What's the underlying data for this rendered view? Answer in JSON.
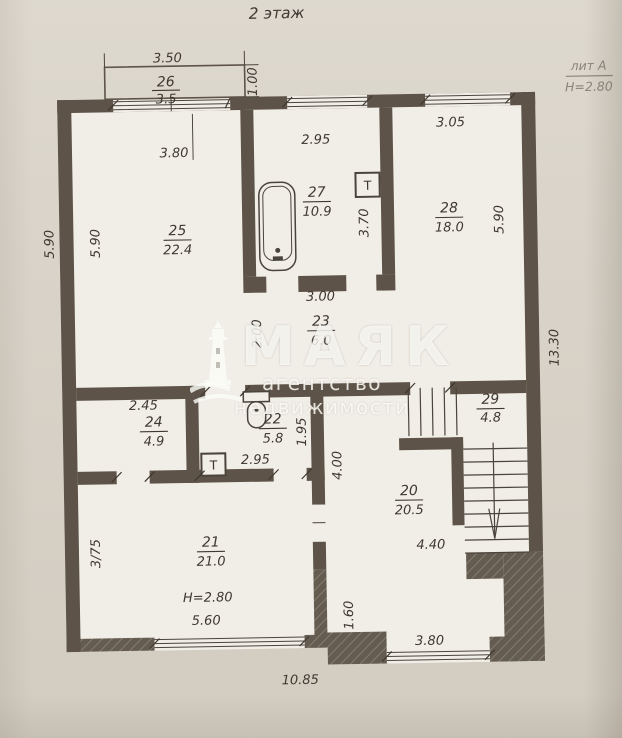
{
  "page": {
    "title": "2 этаж"
  },
  "corner_note": {
    "line1": "лит А",
    "line2": "Н=2.80"
  },
  "watermark": {
    "brand": "МАЯК",
    "subtitle": "агентство недвижимости"
  },
  "rooms": {
    "r20": {
      "number": "20",
      "area": "20.5"
    },
    "r21": {
      "number": "21",
      "area": "21.0"
    },
    "r22": {
      "number": "22",
      "area": "5.8"
    },
    "r23": {
      "number": "23",
      "area": "6.0"
    },
    "r24": {
      "number": "24",
      "area": "4.9"
    },
    "r25": {
      "number": "25",
      "area": "22.4"
    },
    "r26": {
      "number": "26",
      "area": "3.5"
    },
    "r27": {
      "number": "27",
      "area": "10.9"
    },
    "r28": {
      "number": "28",
      "area": "18.0"
    },
    "r29": {
      "number": "29",
      "area": "4.8"
    }
  },
  "dims": {
    "balcony_width": "3.50",
    "balcony_depth": "1.00",
    "room25_width": "3.80",
    "room27_width": "2.95",
    "room28_width": "3.05",
    "outer_left_height": "5.90",
    "room25_height": "5.90",
    "room27_height": "3.70",
    "room28_height": "5.90",
    "outer_right_height": "13.30",
    "room23_width": "3.00",
    "room23_height": "2.00",
    "room24_width": "2.45",
    "room22_width": "2.95",
    "room22_height": "1.95",
    "room20_left_height": "4.00",
    "room20_width": "4.40",
    "room21_left_height": "3/75",
    "room21_ceiling_height": "Н=2.80",
    "room21_window_width": "5.60",
    "room20_step_height": "1.60",
    "room20_window_width": "3.80",
    "building_width": "10.85"
  },
  "symbols": {
    "boiler_bathroom": "Т",
    "boiler_wc": "Т"
  },
  "colors": {
    "paper": "#d9d3c9",
    "plan_paper": "#f1eee7",
    "wall": "#5d5348",
    "ink": "#3e3831",
    "pencil": "#8d8478",
    "watermark": "#fdfcf8"
  }
}
